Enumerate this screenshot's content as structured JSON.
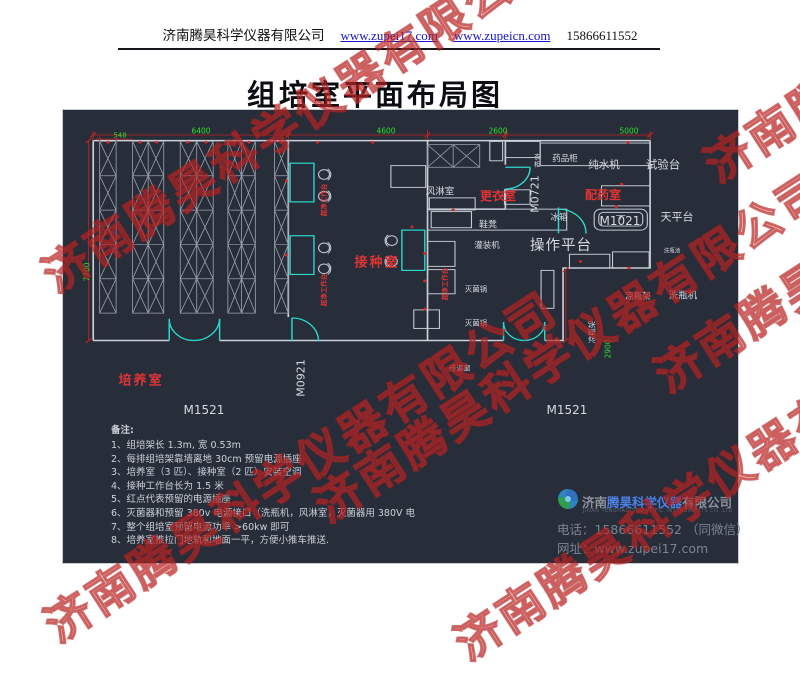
{
  "header": {
    "company": "济南腾昊科学仪器有限公司",
    "url1": "www.zupei17.com",
    "url2": "www.zupeicn.com",
    "phone": "15866611552"
  },
  "title": "组培室平面布局图",
  "watermark": {
    "text": "济南腾昊科学仪器有限公司"
  },
  "plan": {
    "dims": {
      "d548": "548",
      "d6400": "6400",
      "d4600": "4600",
      "d2600": "2600",
      "d5000": "5000",
      "d7700": "7700",
      "d2900": "2900"
    },
    "rooms": {
      "culture": "培养室",
      "inoculation": "接种室",
      "changing": "更衣室",
      "dispensing": "配药室"
    },
    "doors": {
      "m1521_left": "M1521",
      "m1521_right": "M1521",
      "m0921": "M0921",
      "m0721": "M0721",
      "m1021": "M1021"
    },
    "equipment": {
      "air_shower": "风淋室",
      "medicine_cabinet": "药品柜",
      "wardrobe": "衣柜",
      "pure_water_machine": "纯水机",
      "test_bench": "试验台",
      "balance_table": "天平台",
      "fridge": "冰箱",
      "shoe_bench": "鞋凳",
      "filling_machine": "灌装机",
      "operation_platform": "操作平台",
      "bottle_wash_sink": "洗瓶池",
      "clean_bench": "超净工作台",
      "sterilizer": "灭菌锅",
      "transfer_window": "传递窗",
      "bottle_cool_rack": "凉瓶架",
      "bottle_washer": "洗瓶机"
    }
  },
  "notes": {
    "heading": "备注:",
    "items": [
      "1、组培架长 1.3m, 宽 0.53m",
      "2、每排组培架靠墙离地 30cm 预留电源插座",
      "3、培养室（3 匹）、接种室（2 匹）安装空调",
      "4、接种工作台长为 1.5 米",
      "5、红点代表预留的电源插座",
      "6、灭菌器和预留 380v 电源接口（洗瓶机，风淋室，灭菌器用 380V 电",
      "7、整个组培室预留电源功率 >60kw 即可",
      "8、培养室推拉门地轨和地面一平，方便小推车推送."
    ]
  },
  "footer": {
    "name_prefix": "济南",
    "name_highlight": "腾昊科学仪器",
    "name_suffix": "有限公司",
    "english": "JINAN TENGHAO SCIENTIFIC INSTRUMENTS CO.,LTD",
    "phone_label": "电话：",
    "phone": "15866611552 （同微信）",
    "web_label": "网址：",
    "web": "www.zupei17.com"
  },
  "colors": {
    "accent_cyan": "#2bd8cc",
    "dim_green": "#2ae12a",
    "dim_red": "#c42222",
    "room_red": "#e03434",
    "canvas_bg": "#272d39",
    "link_blue": "#1414c8"
  }
}
